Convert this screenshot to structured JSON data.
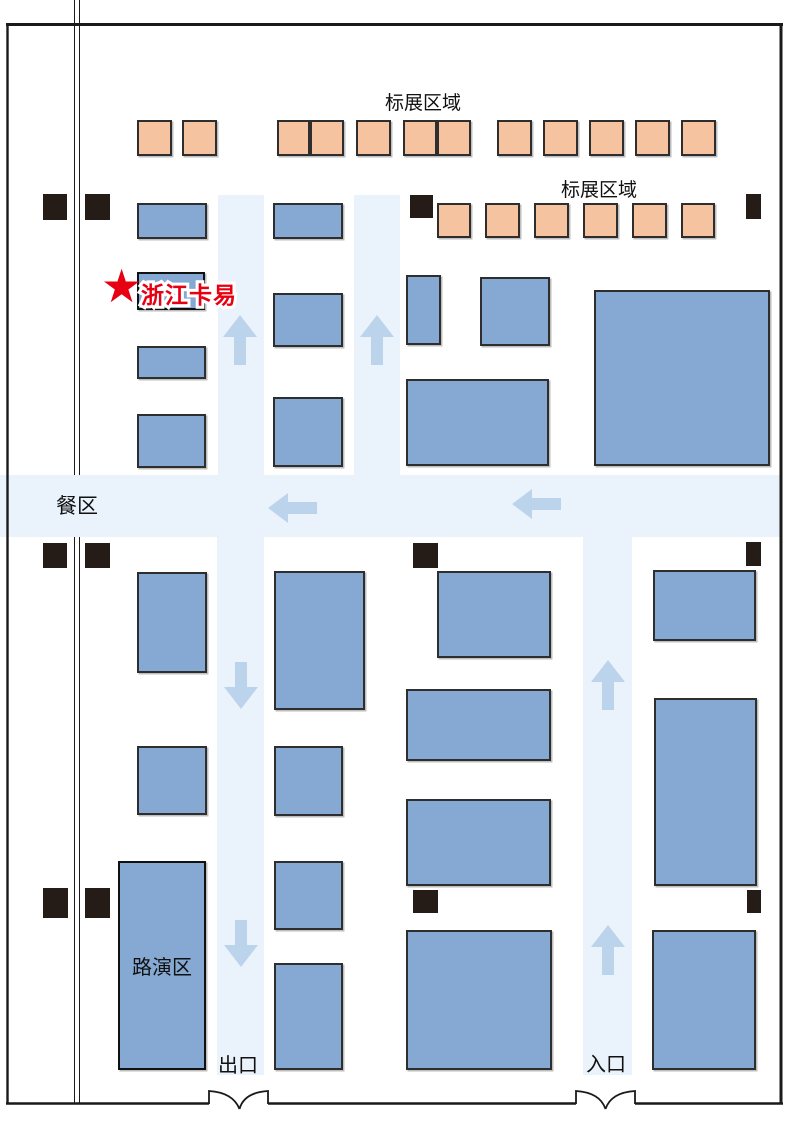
{
  "floorplan": {
    "labels": {
      "standard_booth_area_top": "标展区域",
      "standard_booth_area_right": "标展区域",
      "dining_area": "餐区",
      "roadshow_area": "路演区",
      "exit": "出口",
      "entrance": "入口"
    },
    "highlight": {
      "star": "★",
      "company": "浙江卡易"
    },
    "colors": {
      "booth_blue": "#85a9d3",
      "booth_orange": "#f5c3a0",
      "booth_border": "#2e2e2e",
      "corridor": "#eaf3fc",
      "arrow": "#bcd4eb",
      "pillar": "#261c17",
      "highlight_red": "#e60012",
      "wall": "#1a1a1a"
    },
    "geometry": {
      "blue_booths": [
        [
          137,
          203,
          70,
          36
        ],
        [
          273,
          203,
          70,
          36
        ],
        [
          137,
          346,
          69,
          33
        ],
        [
          137,
          414,
          69,
          54
        ],
        [
          273,
          293,
          70,
          54
        ],
        [
          273,
          397,
          70,
          70
        ],
        [
          406,
          275,
          35,
          70
        ],
        [
          480,
          277,
          70,
          69
        ],
        [
          406,
          379,
          143,
          87
        ],
        [
          594,
          290,
          176,
          176
        ],
        [
          137,
          572,
          70,
          101
        ],
        [
          137,
          746,
          70,
          69
        ],
        [
          274,
          571,
          91,
          139
        ],
        [
          274,
          746,
          69,
          70
        ],
        [
          274,
          861,
          69,
          69
        ],
        [
          274,
          963,
          69,
          107
        ],
        [
          437,
          571,
          114,
          87
        ],
        [
          406,
          689,
          145,
          72
        ],
        [
          406,
          799,
          145,
          87
        ],
        [
          406,
          930,
          146,
          140
        ],
        [
          653,
          570,
          103,
          71
        ],
        [
          654,
          698,
          103,
          188
        ],
        [
          652,
          930,
          104,
          140
        ]
      ],
      "orange_booths": [
        [
          137,
          120,
          35,
          36
        ],
        [
          182,
          120,
          35,
          36
        ],
        [
          277,
          120,
          33,
          36
        ],
        [
          310,
          120,
          34,
          36
        ],
        [
          356,
          120,
          35,
          36
        ],
        [
          403,
          120,
          34,
          36
        ],
        [
          437,
          120,
          34,
          36
        ],
        [
          497,
          120,
          35,
          36
        ],
        [
          543,
          120,
          35,
          36
        ],
        [
          589,
          120,
          35,
          36
        ],
        [
          635,
          120,
          35,
          36
        ],
        [
          681,
          120,
          35,
          36
        ],
        [
          437,
          203,
          34,
          35
        ],
        [
          485,
          203,
          35,
          35
        ],
        [
          534,
          203,
          35,
          35
        ],
        [
          583,
          203,
          35,
          35
        ],
        [
          632,
          203,
          35,
          35
        ],
        [
          681,
          203,
          34,
          35
        ]
      ],
      "highlight_booth": [
        137,
        272,
        68,
        38
      ],
      "roadshow_booth": [
        118,
        861,
        88,
        209
      ],
      "pillars": [
        [
          43,
          194,
          24,
          26
        ],
        [
          85,
          194,
          25,
          26
        ],
        [
          410,
          195,
          23,
          23
        ],
        [
          746,
          194,
          15,
          25
        ],
        [
          43,
          543,
          24,
          25
        ],
        [
          85,
          543,
          25,
          25
        ],
        [
          413,
          543,
          25,
          25
        ],
        [
          746,
          542,
          15,
          24
        ],
        [
          43,
          888,
          25,
          30
        ],
        [
          85,
          888,
          25,
          30
        ],
        [
          413,
          890,
          25,
          23
        ],
        [
          747,
          890,
          14,
          23
        ]
      ],
      "corridors": [
        [
          218,
          195,
          46,
          280
        ],
        [
          354,
          195,
          46,
          280
        ],
        [
          0,
          475,
          781,
          62
        ],
        [
          217,
          537,
          47,
          538
        ],
        [
          583,
          537,
          49,
          538
        ]
      ],
      "arrows": [
        {
          "dir": "up",
          "x": 223,
          "y": 315
        },
        {
          "dir": "up",
          "x": 360,
          "y": 315
        },
        {
          "dir": "left",
          "x": 268,
          "y": 493
        },
        {
          "dir": "left",
          "x": 512,
          "y": 489
        },
        {
          "dir": "down",
          "x": 224,
          "y": 662
        },
        {
          "dir": "down",
          "x": 224,
          "y": 920
        },
        {
          "dir": "up",
          "x": 591,
          "y": 660
        },
        {
          "dir": "up",
          "x": 591,
          "y": 925
        }
      ]
    }
  }
}
